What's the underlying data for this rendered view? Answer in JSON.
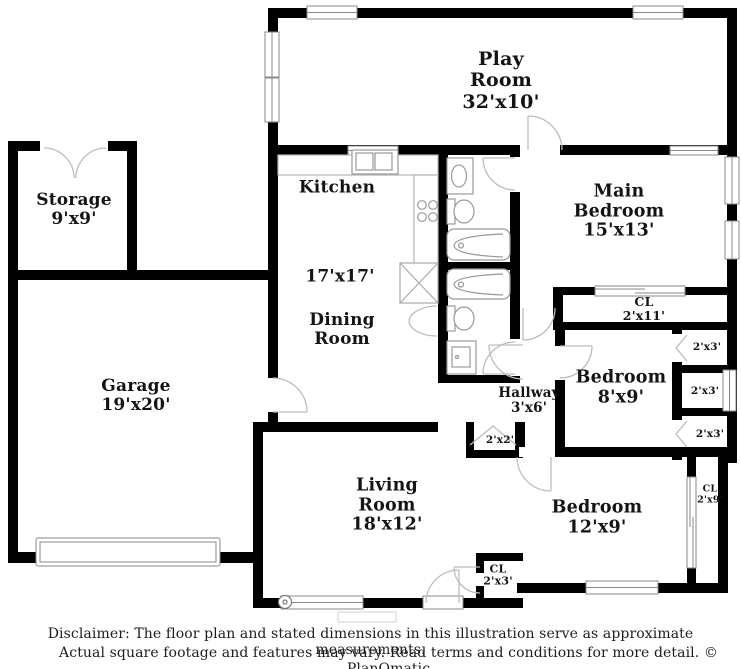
{
  "colors": {
    "wall": "#000000",
    "label_text": "#141414",
    "fixture_line": "#999999"
  },
  "rooms": {
    "play_room": {
      "name": "Play Room",
      "dims": "32'x10'"
    },
    "storage": {
      "name": "Storage",
      "dims": "9'x9'"
    },
    "kitchen": {
      "name": "Kitchen",
      "dims": ""
    },
    "dining_room": {
      "name": "Dining Room",
      "dims": "17'x17'"
    },
    "garage": {
      "name": "Garage",
      "dims": "19'x20'"
    },
    "main_bedroom": {
      "name": "Main Bedroom",
      "dims": "15'x13'"
    },
    "main_closet": {
      "name": "CL",
      "dims": "2'x11'"
    },
    "bedroom_8x9": {
      "name": "Bedroom",
      "dims": "8'x9'"
    },
    "hallway": {
      "name": "Hallway",
      "dims": "3'x6'"
    },
    "closet_2x2": {
      "name": "",
      "dims": "2'x2'"
    },
    "closet_2x3_top": {
      "name": "",
      "dims": "2'x3'"
    },
    "closet_2x3_mid": {
      "name": "",
      "dims": "2'x3'"
    },
    "closet_2x3_bot": {
      "name": "",
      "dims": "2'x3'"
    },
    "living_room": {
      "name": "Living Room",
      "dims": "18'x12'"
    },
    "living_closet": {
      "name": "CL",
      "dims": "2'x3'"
    },
    "bedroom_12x9": {
      "name": "Bedroom",
      "dims": "12'x9'"
    },
    "bedroom_12x9_closet": {
      "name": "CL",
      "dims": "2'x9'"
    }
  },
  "footer": {
    "line1": "Disclaimer: The floor plan and stated dimensions in this illustration serve as approximate measurements.",
    "line2": "Actual square footage and features may vary. Read terms and conditions for more detail. © PlanOmatic"
  }
}
